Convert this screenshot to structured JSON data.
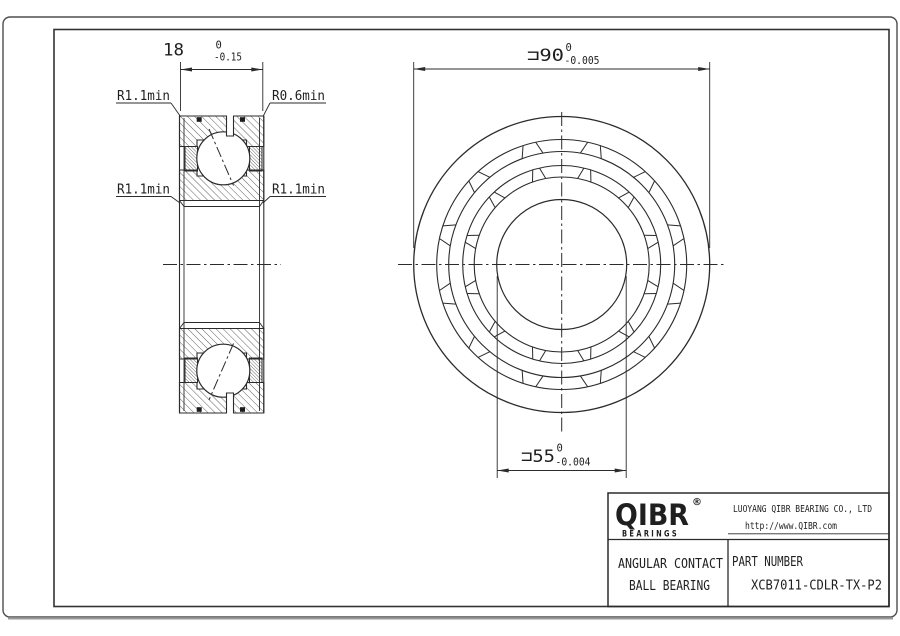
{
  "drawing": {
    "section_view": {
      "width_dim": {
        "value": "18",
        "tol_top": "0",
        "tol_bottom": "-0.15"
      },
      "radius_labels": {
        "top_left": "R1.1min",
        "top_right": "R0.6min",
        "mid_left": "R1.1min",
        "mid_right": "R1.1min"
      }
    },
    "front_view": {
      "outer_dim": {
        "value": "⊐90",
        "tol_top": "0",
        "tol_bottom": "-0.005"
      },
      "bore_dim": {
        "value": "⊐55",
        "tol_top": "0",
        "tol_bottom": "-0.004"
      }
    },
    "title_block": {
      "brand": {
        "name": "QIBR",
        "registered": "®",
        "tagline": "BEARINGS"
      },
      "company_name": "LUOYANG QIBR BEARING CO., LTD",
      "website": "http://www.QIBR.com",
      "product_type_line1": "ANGULAR CONTACT",
      "product_type_line2": "BALL BEARING",
      "part_number_label": "PART NUMBER",
      "part_number": "XCB7011-CDLR-TX-P2"
    },
    "colors": {
      "line": "#2b2b2b",
      "border": "#4e4e4e"
    }
  }
}
